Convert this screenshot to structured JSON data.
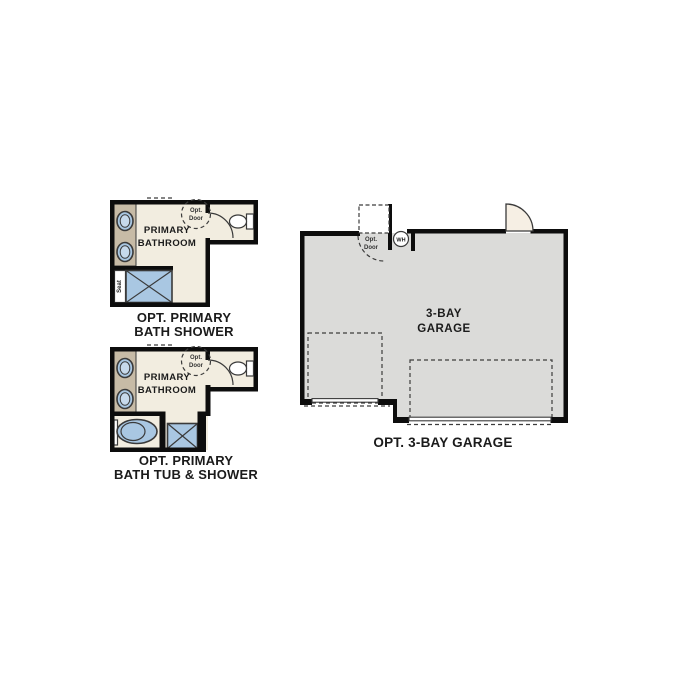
{
  "colors": {
    "wall": "#0d0d0d",
    "floor_cream": "#f2ede0",
    "vanity_tan": "#c7bba6",
    "fixture_blue": "#a9c7e2",
    "fixture_blue_light": "#c6d9eb",
    "garage_gray": "#dbdbd9",
    "door_fill": "#f6efe4",
    "outline_dark": "#3a3a3a",
    "dash": "#3c3c3c",
    "label": "#1b1b1b"
  },
  "plans": {
    "bath_shower": {
      "room_label": {
        "line1": "PRIMARY",
        "line2": "BATHROOM"
      },
      "opt_door": {
        "line1": "Opt.",
        "line2": "Door"
      },
      "seat_label": "Seat",
      "caption": {
        "line1": "OPT. PRIMARY",
        "line2": "BATH SHOWER"
      }
    },
    "bath_tub_shower": {
      "room_label": {
        "line1": "PRIMARY",
        "line2": "BATHROOM"
      },
      "opt_door": {
        "line1": "Opt.",
        "line2": "Door"
      },
      "caption": {
        "line1": "OPT. PRIMARY",
        "line2": "BATH TUB & SHOWER"
      }
    },
    "garage": {
      "room_label": {
        "line1": "3-BAY",
        "line2": "GARAGE"
      },
      "water_heater_label": "WH",
      "opt_door": {
        "line1": "Opt.",
        "line2": "Door"
      },
      "caption": "OPT. 3-BAY GARAGE"
    }
  }
}
